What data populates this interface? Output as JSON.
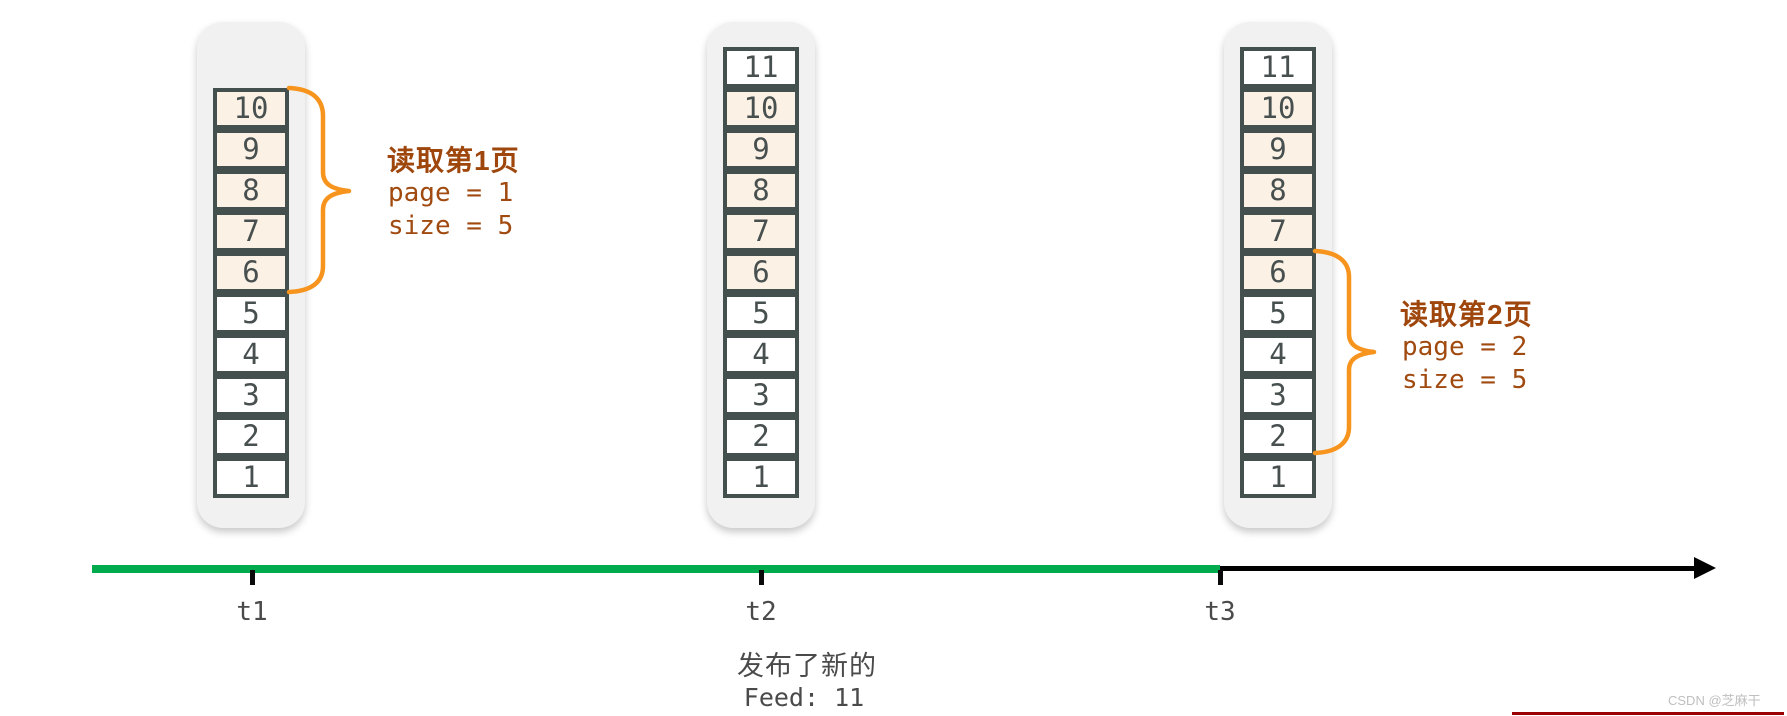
{
  "stacks": [
    {
      "name": "feed-stack-t1",
      "cells": [
        {
          "value": "10",
          "highlighted": true
        },
        {
          "value": "9",
          "highlighted": true
        },
        {
          "value": "8",
          "highlighted": true
        },
        {
          "value": "7",
          "highlighted": true
        },
        {
          "value": "6",
          "highlighted": true
        },
        {
          "value": "5",
          "highlighted": false
        },
        {
          "value": "4",
          "highlighted": false
        },
        {
          "value": "3",
          "highlighted": false
        },
        {
          "value": "2",
          "highlighted": false
        },
        {
          "value": "1",
          "highlighted": false
        }
      ]
    },
    {
      "name": "feed-stack-t2",
      "cells": [
        {
          "value": "11",
          "highlighted": false
        },
        {
          "value": "10",
          "highlighted": true
        },
        {
          "value": "9",
          "highlighted": true
        },
        {
          "value": "8",
          "highlighted": true
        },
        {
          "value": "7",
          "highlighted": true
        },
        {
          "value": "6",
          "highlighted": true
        },
        {
          "value": "5",
          "highlighted": false
        },
        {
          "value": "4",
          "highlighted": false
        },
        {
          "value": "3",
          "highlighted": false
        },
        {
          "value": "2",
          "highlighted": false
        },
        {
          "value": "1",
          "highlighted": false
        }
      ]
    },
    {
      "name": "feed-stack-t3",
      "cells": [
        {
          "value": "11",
          "highlighted": false
        },
        {
          "value": "10",
          "highlighted": true
        },
        {
          "value": "9",
          "highlighted": true
        },
        {
          "value": "8",
          "highlighted": true
        },
        {
          "value": "7",
          "highlighted": true
        },
        {
          "value": "6",
          "highlighted": true
        },
        {
          "value": "5",
          "highlighted": false
        },
        {
          "value": "4",
          "highlighted": false
        },
        {
          "value": "3",
          "highlighted": false
        },
        {
          "value": "2",
          "highlighted": false
        },
        {
          "value": "1",
          "highlighted": false
        }
      ]
    }
  ],
  "annotations": {
    "page1": {
      "title": "读取第1页",
      "line1": "page = 1",
      "line2": "size = 5"
    },
    "page2": {
      "title": "读取第2页",
      "line1": "page = 2",
      "line2": "size = 5"
    }
  },
  "timeline": {
    "tick1": "t1",
    "tick2": "t2",
    "tick3": "t3"
  },
  "caption": {
    "line1": "发布了新的",
    "line2": "Feed: 11"
  },
  "watermark": "CSDN @芝麻干",
  "colors": {
    "brace_orange": "#f7941e",
    "annotation_brown": "#a04a10",
    "timeline_green": "#00ab4e",
    "timeline_black": "#000000",
    "cell_highlight": "#fbf1e4",
    "cell_border": "#43504e",
    "stack_background": "#f1f1f1",
    "watermark_red": "#9b0000"
  }
}
